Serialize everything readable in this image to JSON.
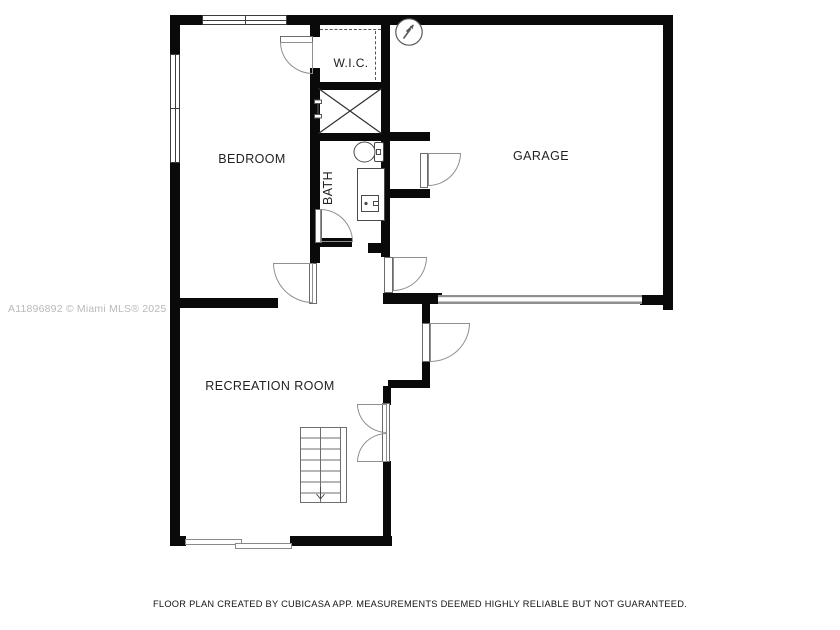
{
  "plan": {
    "type": "floor-plan",
    "rooms": [
      {
        "id": "bedroom",
        "label": "BEDROOM"
      },
      {
        "id": "wic",
        "label": "W.I.C."
      },
      {
        "id": "bath",
        "label": "BATH"
      },
      {
        "id": "garage",
        "label": "GARAGE"
      },
      {
        "id": "recreation-room",
        "label": "RECREATION ROOM"
      }
    ],
    "symbols": [
      "north-arrow-icon",
      "stairs-down",
      "shower-x",
      "toilet",
      "sink-vanity",
      "garage-door",
      "sliding-glass-door",
      "window",
      "door-swing-arc",
      "closet-dashed-rod"
    ],
    "colors": {
      "wall": "#0a0a0a",
      "background": "#ffffff",
      "door_arc": "#8f8f8f",
      "label": "#222222",
      "watermark": "#b9b9b9"
    }
  },
  "watermark": {
    "text": "A11896892 © Miami MLS® 2025"
  },
  "footer": {
    "text": "FLOOR PLAN CREATED BY CUBICASA APP. MEASUREMENTS DEEMED HIGHLY RELIABLE BUT NOT GUARANTEED."
  }
}
